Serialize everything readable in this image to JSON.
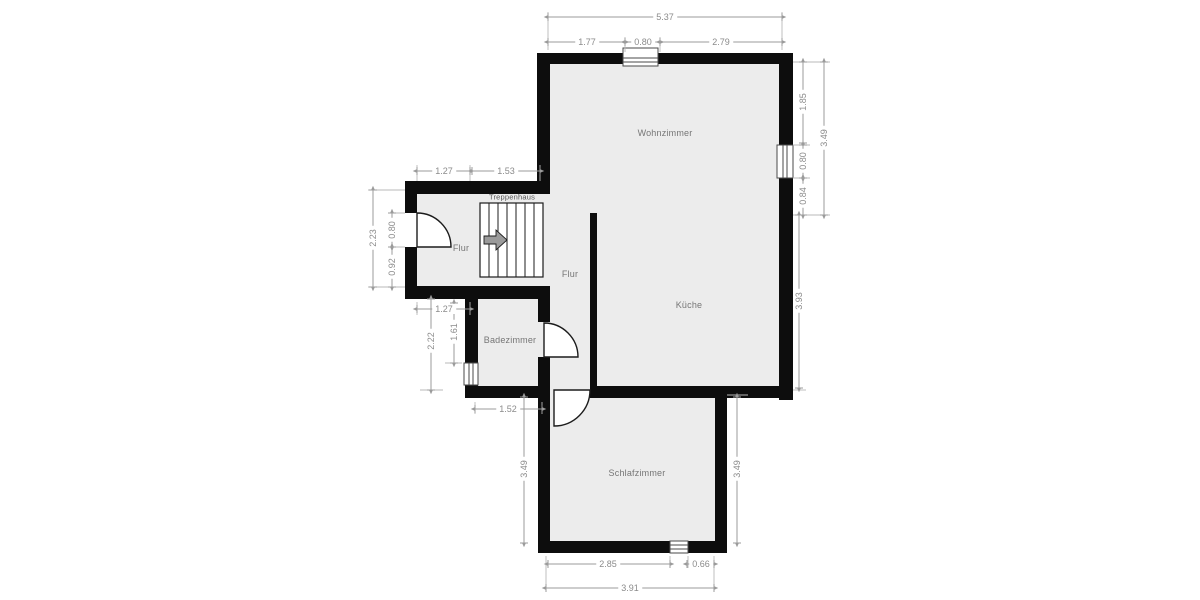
{
  "rooms": {
    "living": {
      "label": "Wohnzimmer"
    },
    "kitchen": {
      "label": "Küche"
    },
    "hall_entry": {
      "label": "Flur"
    },
    "hall_corridor": {
      "label": "Flur"
    },
    "staircase": {
      "label": "Treppenhaus"
    },
    "bath": {
      "label": "Badezimmer"
    },
    "bedroom": {
      "label": "Schlafzimmer"
    }
  },
  "dims": {
    "top_total": "5.37",
    "top_left": "1.77",
    "top_window": "0.80",
    "top_right": "2.79",
    "right_upper_a": "1.85",
    "right_window": "0.80",
    "right_upper_b": "0.84",
    "right_upper_total": "3.49",
    "right_lower": "3.93",
    "stair_top_a": "1.27",
    "stair_top_b": "1.53",
    "stair_left_total": "2.23",
    "stair_door": "0.80",
    "stair_left_b": "0.92",
    "bath_top": "1.27",
    "bath_left_a": "1.61",
    "bath_left_total": "2.22",
    "bath_bottom": "1.52",
    "bed_left": "3.49",
    "bed_right": "3.49",
    "bed_bottom_a": "2.85",
    "bed_bottom_b": "0.66",
    "bed_bottom_total": "3.91"
  },
  "colors": {
    "wall": "#0d0d0d",
    "floor": "#ececec",
    "dimension": "#9b9b9b",
    "room_text": "#767676",
    "background": "#ffffff"
  }
}
